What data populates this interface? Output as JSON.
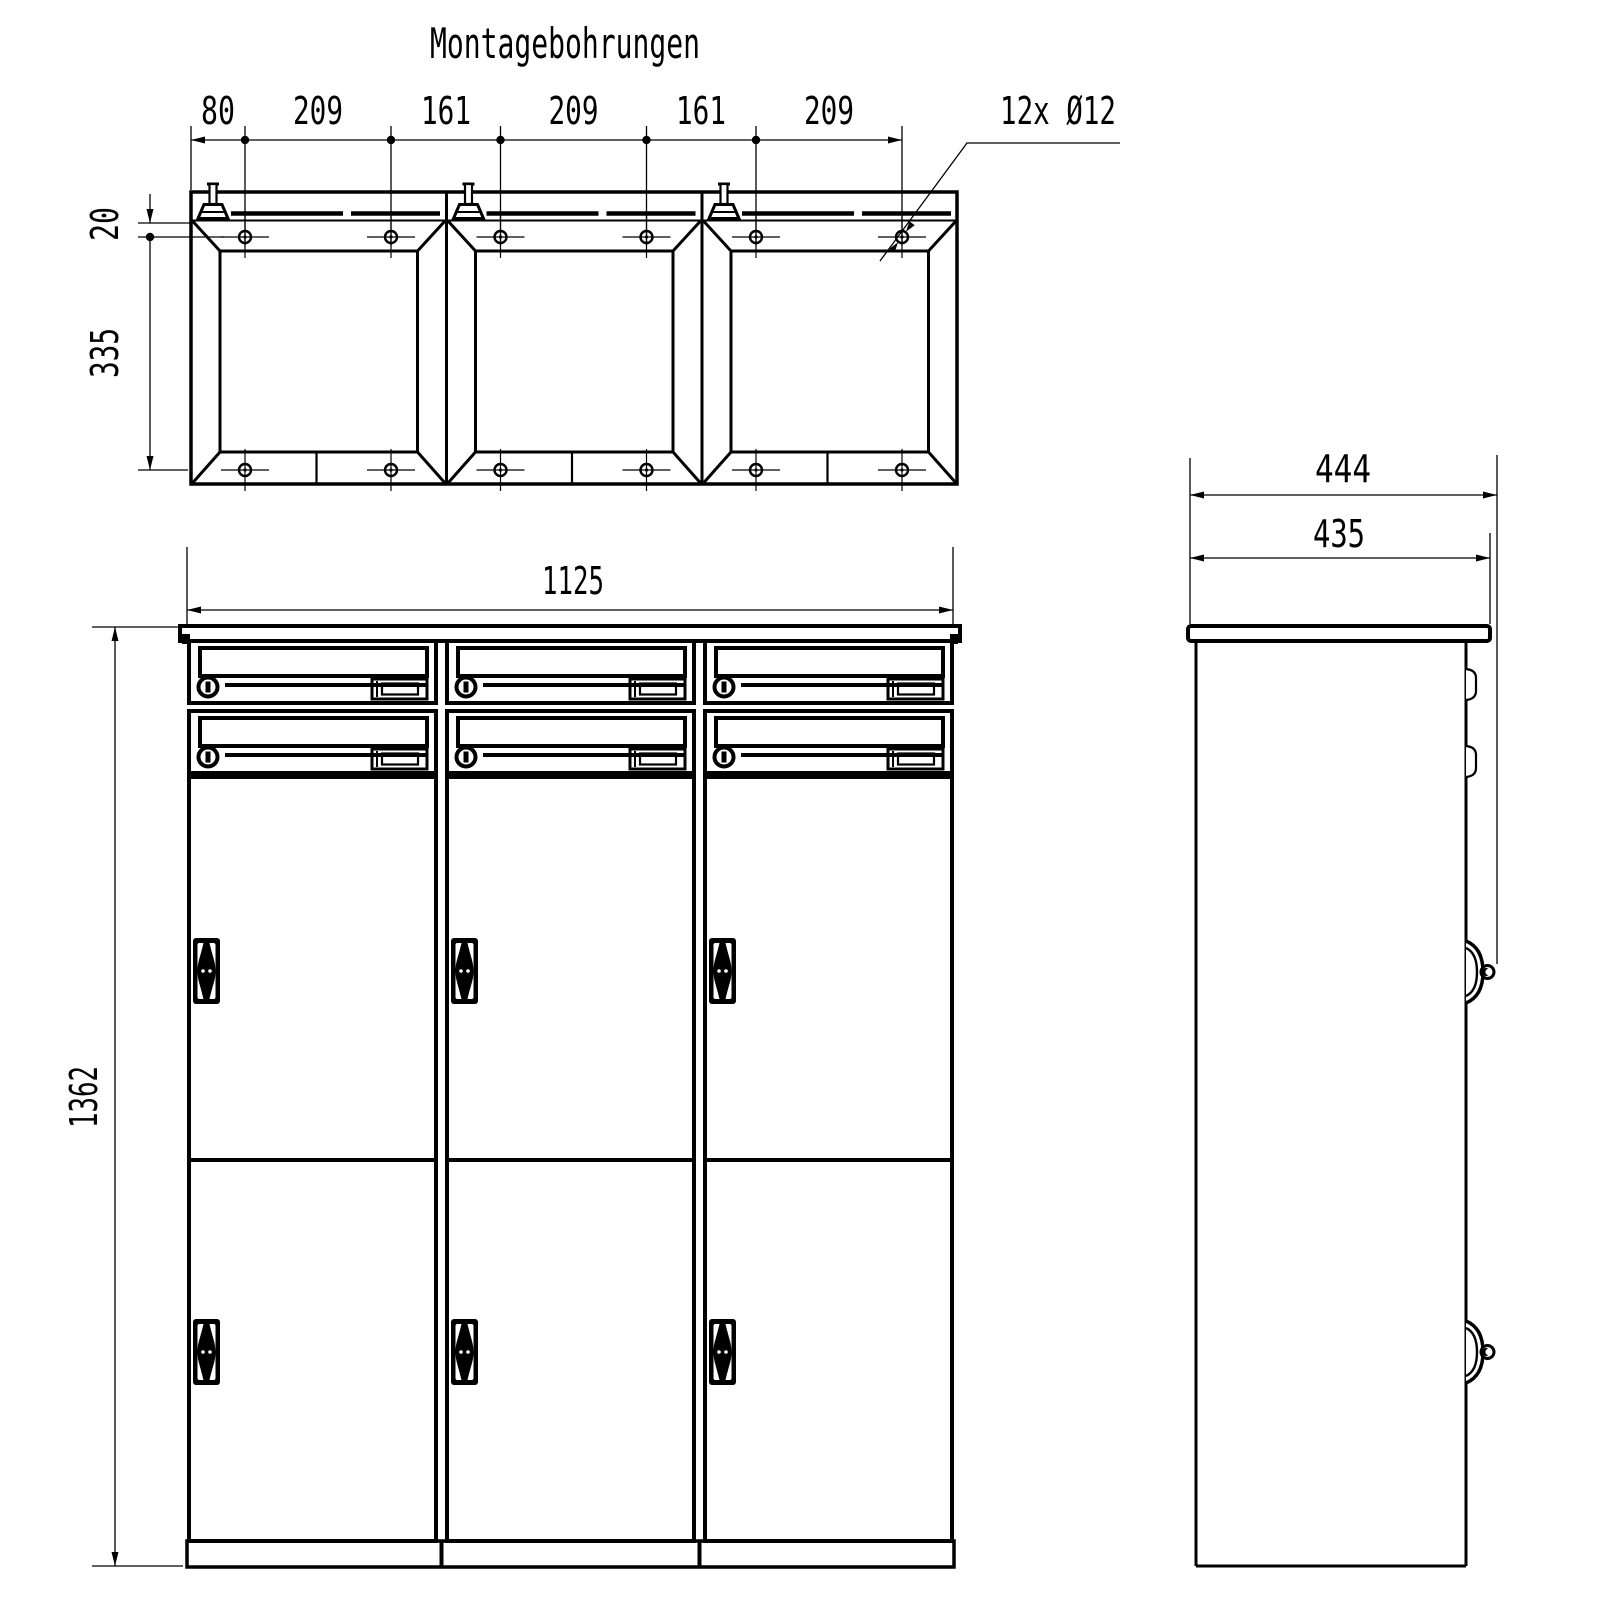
{
  "title": "Montagebohrungen",
  "top_view": {
    "hole_note": "12x Ø12",
    "dim_chain": [
      "80",
      "209",
      "161",
      "209",
      "161",
      "209"
    ],
    "dim_top_offset": "20",
    "dim_hole_spacing": "335"
  },
  "front_view": {
    "dim_width": "1125",
    "dim_height": "1362"
  },
  "side_view": {
    "dim_depth_overall": "444",
    "dim_depth_body": "435"
  }
}
